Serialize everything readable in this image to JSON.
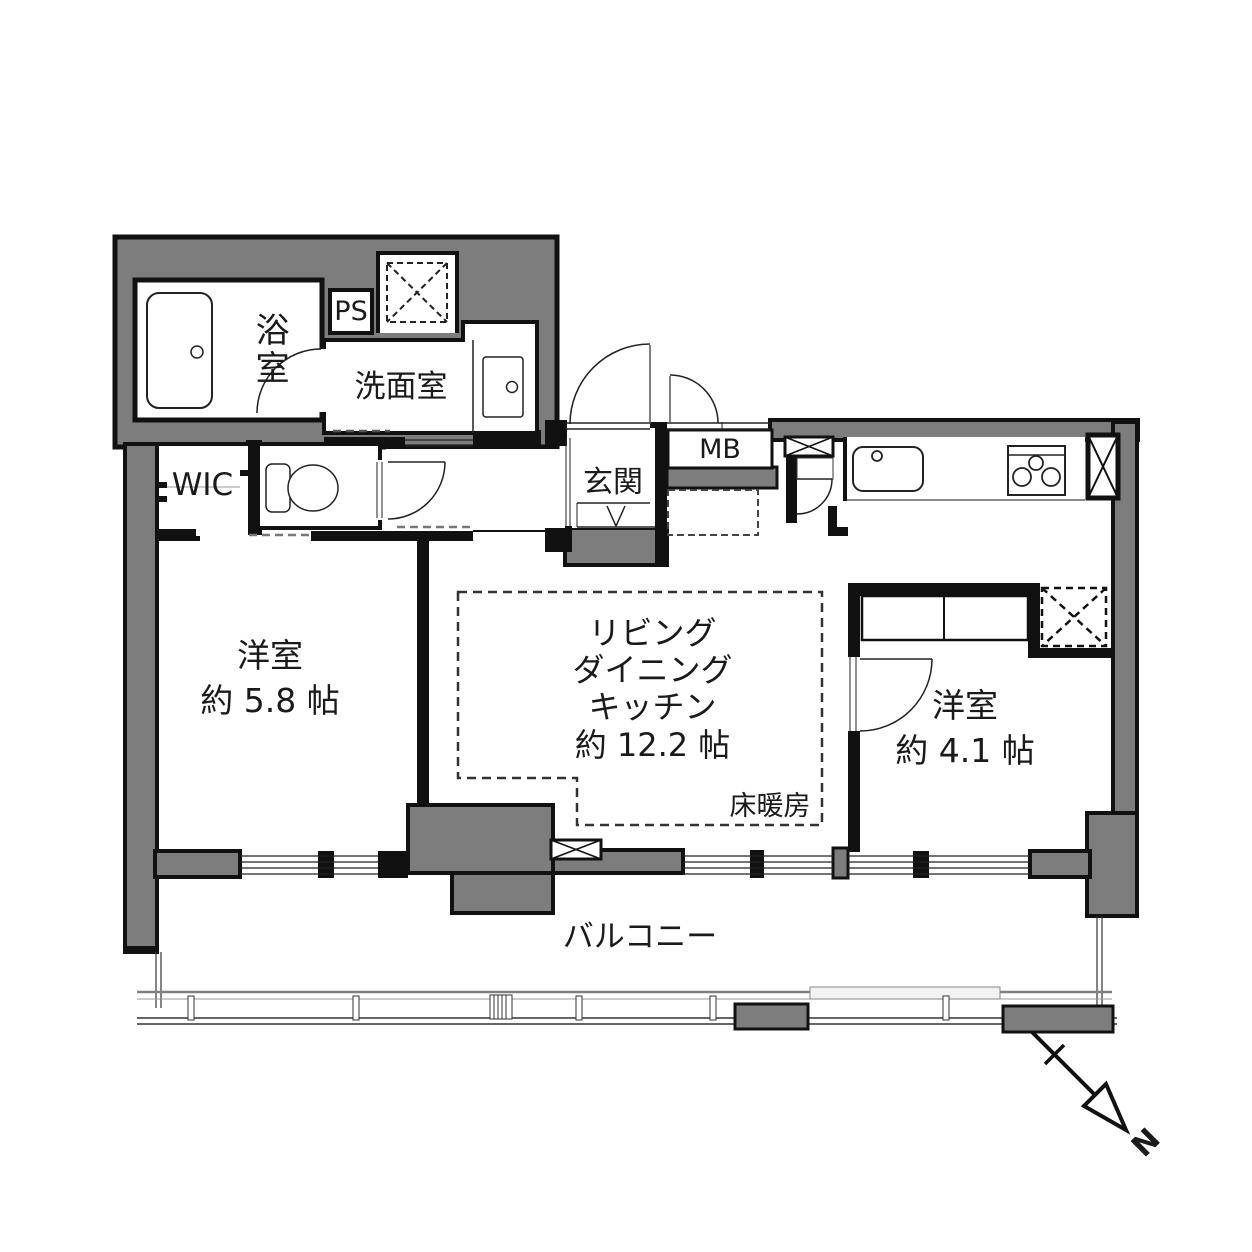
{
  "plan": {
    "rooms": {
      "bathroom": {
        "label": "浴室"
      },
      "pipe_space": {
        "label": "PS"
      },
      "washroom": {
        "label": "洗面室"
      },
      "wic": {
        "label": "WIC"
      },
      "entrance": {
        "label": "玄関"
      },
      "meter_box": {
        "label": "MB"
      },
      "ldk": {
        "l1": "リビング",
        "l2": "ダイニング",
        "l3": "キッチン",
        "l4": "約 12.2 帖",
        "floor_heating": "床暖房"
      },
      "bedroom_left": {
        "name": "洋室",
        "size": "約 5.8 帖"
      },
      "bedroom_right": {
        "name": "洋室",
        "size": "約 4.1 帖"
      },
      "balcony": {
        "label": "バルコニー"
      }
    },
    "compass": {
      "label": "N"
    },
    "colors": {
      "wall_gray": "#7d7d7d",
      "line_black": "#111111"
    }
  }
}
